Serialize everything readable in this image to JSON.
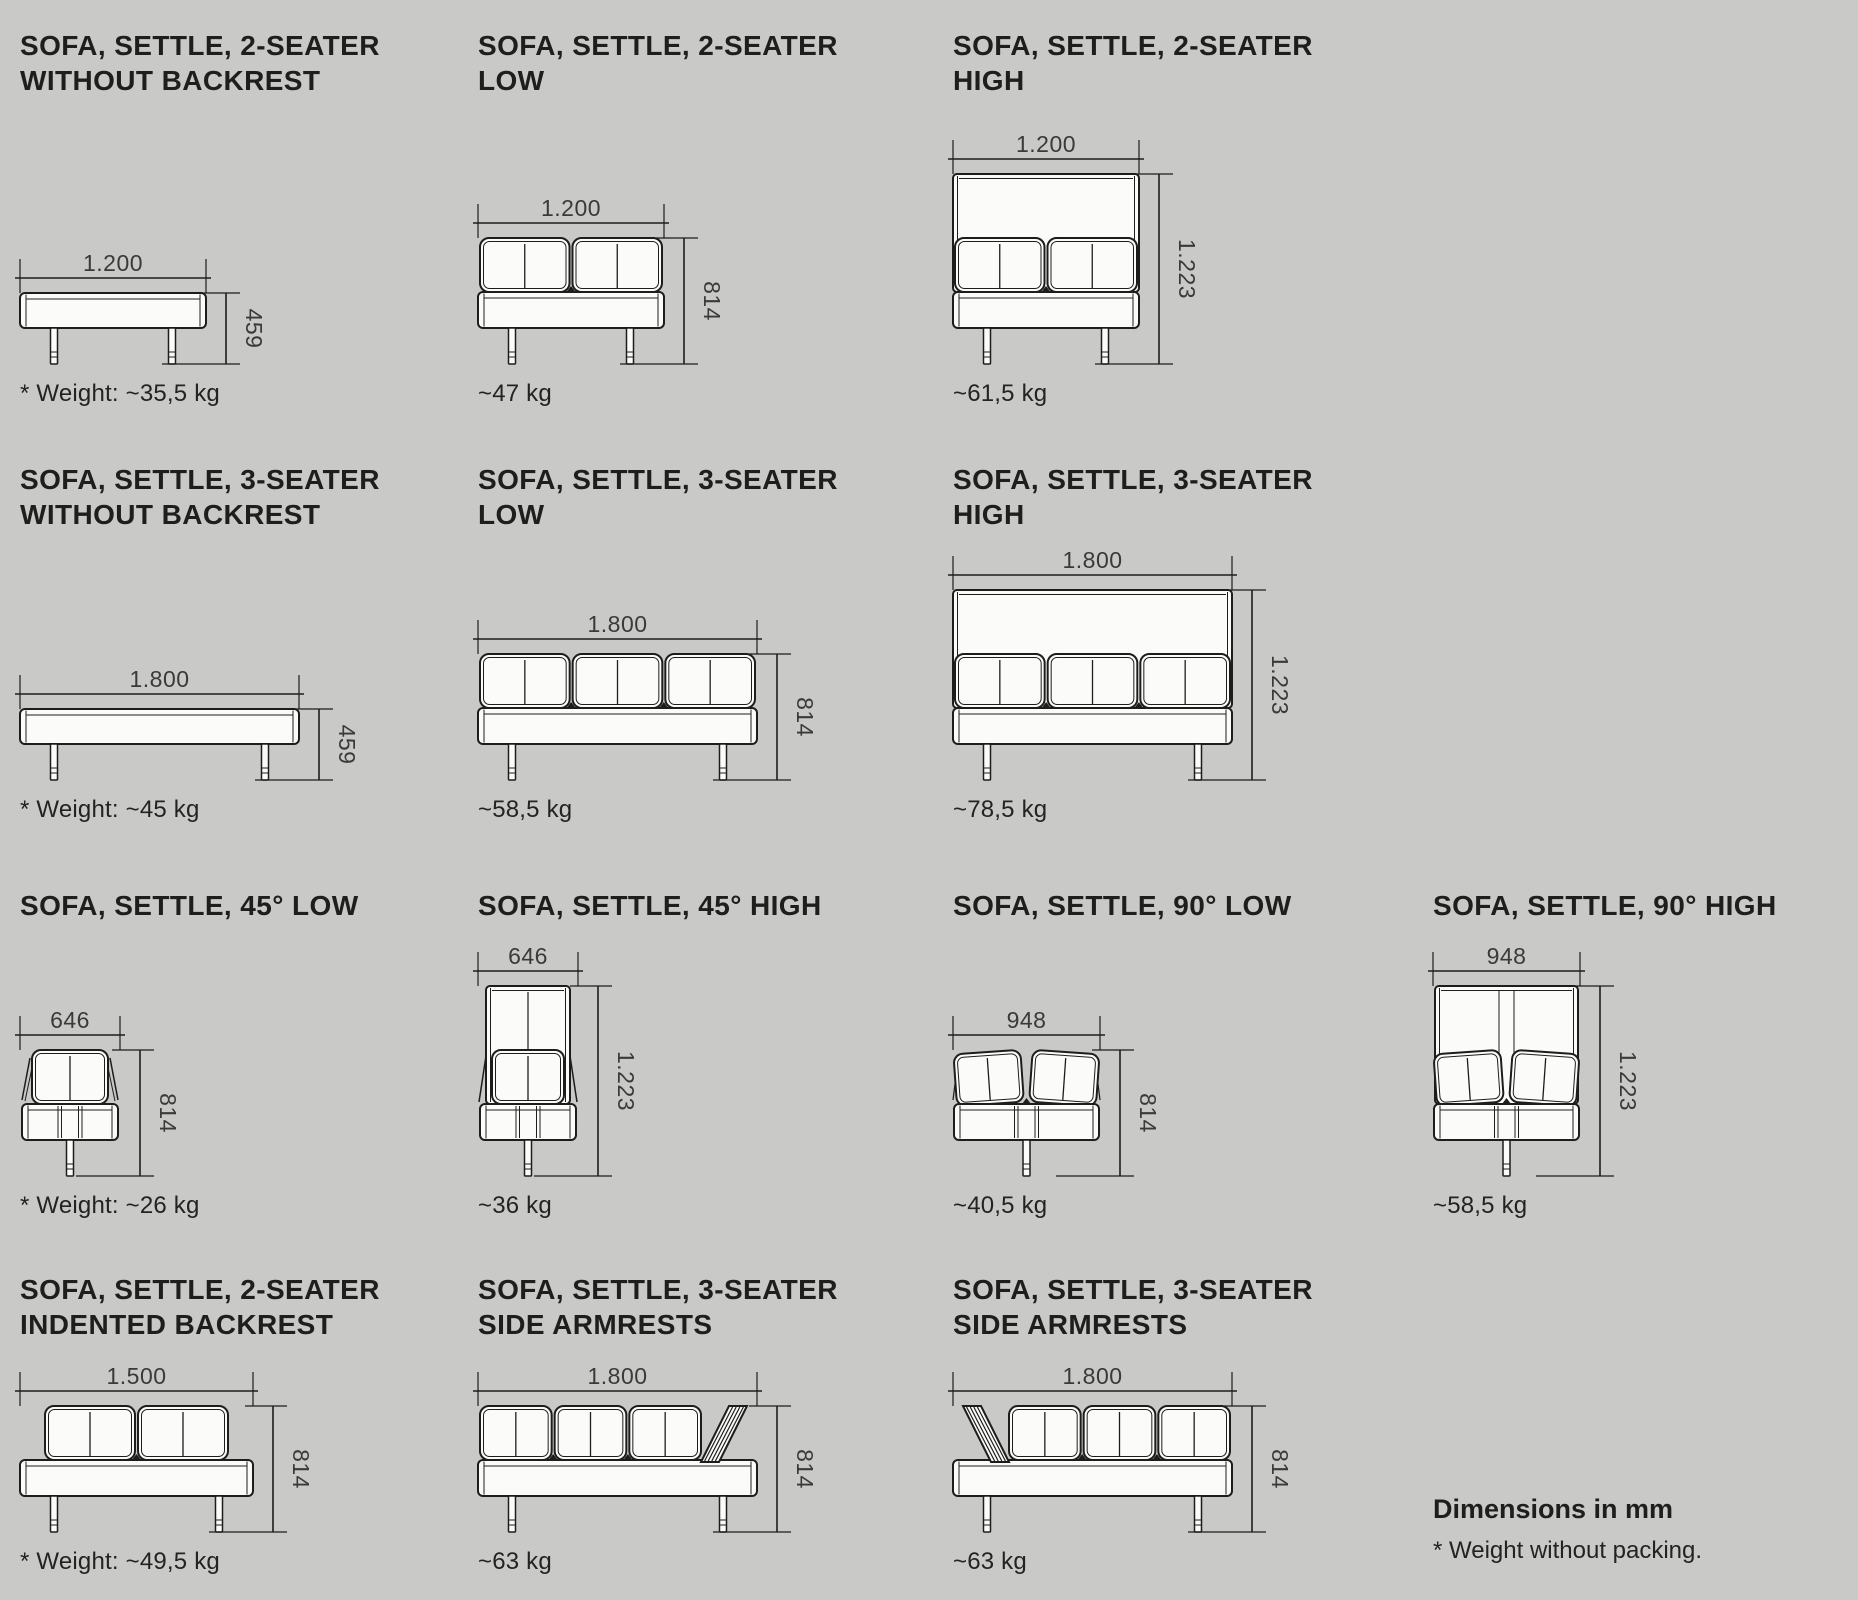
{
  "page": {
    "background": "#c9c9c7",
    "ink": "#1d1d1b",
    "dim_color": "#3a3a38"
  },
  "notes": {
    "dimensions": "Dimensions in mm",
    "weight": "* Weight without packing."
  },
  "cells": [
    {
      "id": "2-seater-without-backrest",
      "title1": "SOFA, SETTLE, 2-SEATER",
      "title2": "WITHOUT BACKREST",
      "drawing": "bench",
      "seats": 2,
      "width_label": "1.200",
      "height_label": "459",
      "weight": "* Weight: ~35,5 kg"
    },
    {
      "id": "2-seater-low",
      "title1": "SOFA, SETTLE, 2-SEATER",
      "title2": "LOW",
      "drawing": "low",
      "seats": 2,
      "width_label": "1.200",
      "height_label": "814",
      "weight": "~47 kg"
    },
    {
      "id": "2-seater-high",
      "title1": "SOFA, SETTLE, 2-SEATER",
      "title2": "HIGH",
      "drawing": "high",
      "seats": 2,
      "width_label": "1.200",
      "height_label": "1.223",
      "weight": "~61,5 kg"
    },
    {
      "id": "3-seater-without-backrest",
      "title1": "SOFA, SETTLE, 3-SEATER",
      "title2": "WITHOUT BACKREST",
      "drawing": "bench",
      "seats": 3,
      "width_label": "1.800",
      "height_label": "459",
      "weight": "* Weight: ~45 kg"
    },
    {
      "id": "3-seater-low",
      "title1": "SOFA, SETTLE, 3-SEATER",
      "title2": "LOW",
      "drawing": "low",
      "seats": 3,
      "width_label": "1.800",
      "height_label": "814",
      "weight": "~58,5 kg"
    },
    {
      "id": "3-seater-high",
      "title1": "SOFA, SETTLE, 3-SEATER",
      "title2": "HIGH",
      "drawing": "high",
      "seats": 3,
      "width_label": "1.800",
      "height_label": "1.223",
      "weight": "~78,5 kg"
    },
    {
      "id": "45-low",
      "title1": "SOFA, SETTLE, 45° LOW",
      "title2": "",
      "drawing": "corner45-low",
      "seats": 1,
      "width_label": "646",
      "height_label": "814",
      "weight": "* Weight: ~26 kg"
    },
    {
      "id": "45-high",
      "title1": "SOFA, SETTLE, 45° HIGH",
      "title2": "",
      "drawing": "corner45-high",
      "seats": 1,
      "width_label": "646",
      "height_label": "1.223",
      "weight": "~36 kg"
    },
    {
      "id": "90-low",
      "title1": "SOFA, SETTLE, 90° LOW",
      "title2": "",
      "drawing": "corner90-low",
      "seats": 2,
      "width_label": "948",
      "height_label": "814",
      "weight": "~40,5 kg"
    },
    {
      "id": "90-high",
      "title1": "SOFA, SETTLE, 90° HIGH",
      "title2": "",
      "drawing": "corner90-high",
      "seats": 2,
      "width_label": "948",
      "height_label": "1.223",
      "weight": "~58,5 kg"
    },
    {
      "id": "2-seater-indented-backrest",
      "title1": "SOFA, SETTLE, 2-SEATER",
      "title2": "INDENTED BACKREST",
      "drawing": "indented",
      "seats": 2,
      "width_label": "1.500",
      "height_label": "814",
      "weight": "* Weight: ~49,5 kg"
    },
    {
      "id": "3-seater-side-armrests-right",
      "title1": "SOFA, SETTLE, 3-SEATER",
      "title2": "SIDE ARMRESTS",
      "drawing": "armrest-right",
      "seats": 3,
      "width_label": "1.800",
      "height_label": "814",
      "weight": "~63 kg"
    },
    {
      "id": "3-seater-side-armrests-left",
      "title1": "SOFA, SETTLE, 3-SEATER",
      "title2": "SIDE ARMRESTS",
      "drawing": "armrest-left",
      "seats": 3,
      "width_label": "1.800",
      "height_label": "814",
      "weight": "~63 kg"
    }
  ]
}
